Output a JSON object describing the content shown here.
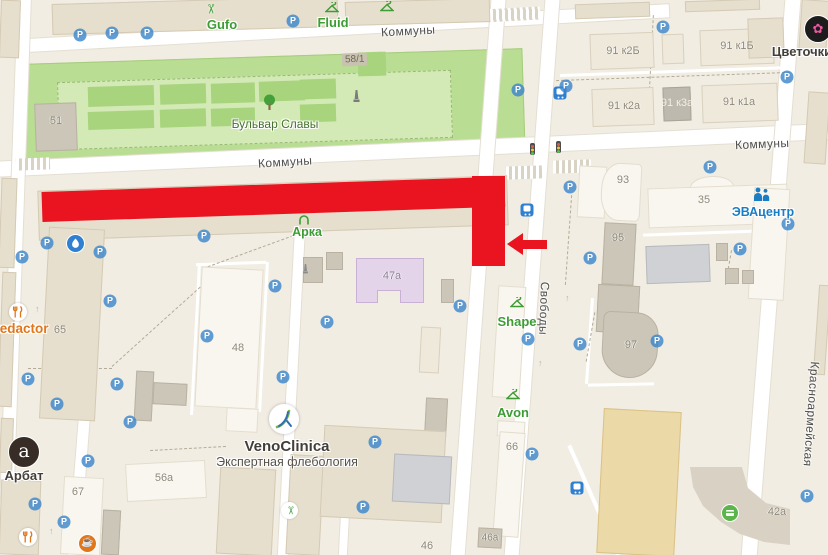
{
  "map": {
    "streets": {
      "kommuny": "Коммуны",
      "svobody": "Свободы",
      "krasnoarmeyskaya": "Красноармейская"
    },
    "park": {
      "name": "Бульвар Славы"
    },
    "buildings": {
      "b51": "51",
      "b58_1": "58/1",
      "b91k2b": "91 к2Б",
      "b91k1b": "91 к1Б",
      "b91k2a": "91 к2а",
      "b91k3a": "91 к3а",
      "b91k1a": "91 к1а",
      "b93": "93",
      "b95": "95",
      "b97": "97",
      "b35": "35",
      "b47a": "47а",
      "b48": "48",
      "b65": "65",
      "b66": "66",
      "b67": "67",
      "b56a": "56а",
      "b46a": "46а",
      "b46": "46",
      "b42a": "42а"
    },
    "pois": {
      "gufo": "Gufo",
      "fluid": "Fluid",
      "tsvetochki": "Цветочки",
      "arka": "Арка",
      "shape": "Shape",
      "avon": "Avon",
      "eva": "ЭВАцентр",
      "venoclinica_name": "VenoClinica",
      "venoclinica_sub": "Экспертная флебология",
      "arbat": "Арбат",
      "arbat_logo_letter": "a",
      "redactor": "Redactor"
    },
    "icons": {
      "parking": "P"
    },
    "colors": {
      "route_red": "#e9141f",
      "poi_green": "#3e9c35",
      "poi_blue": "#1b7ec5",
      "poi_orange": "#e2761b",
      "park_green": "#b9dd92"
    }
  }
}
